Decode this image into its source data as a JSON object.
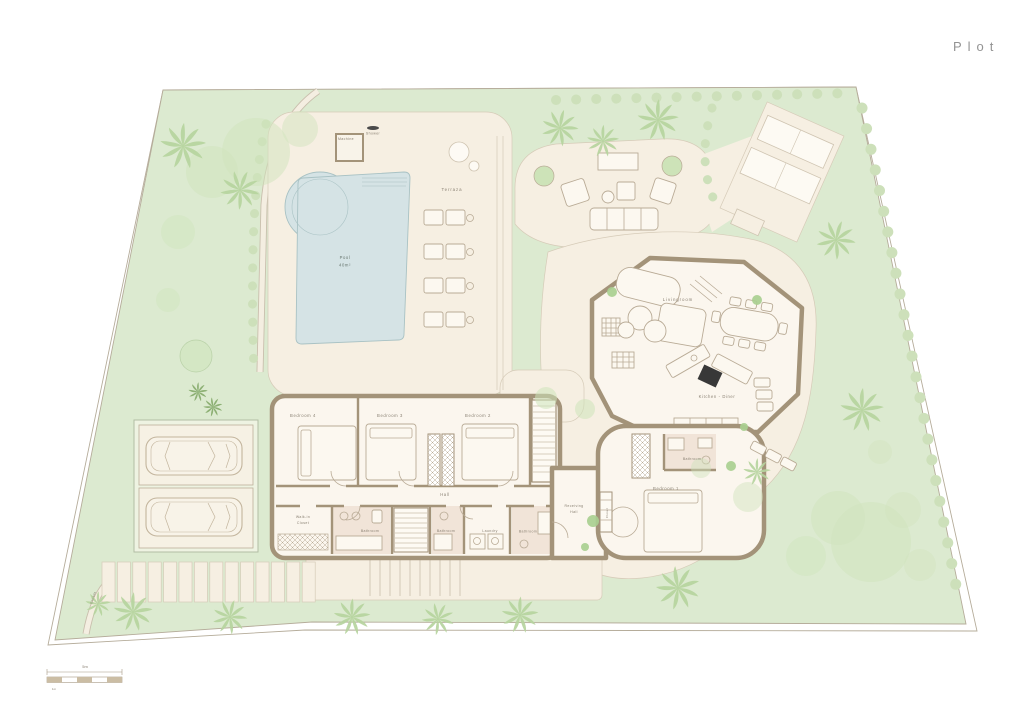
{
  "title": "Plot",
  "plan": {
    "outdoor": {
      "machine": "Machine",
      "shower": "Shower",
      "terrace": "Terraza",
      "pool_name": "Pool",
      "pool_area": "40m²",
      "entrance": "Entrada"
    },
    "house": {
      "livingroom": "Livingroom",
      "kitchen_diner": "Kitchen - Diner",
      "bedroom1": "Bedroom 1",
      "bedroom2": "Bedroom 2",
      "bedroom3": "Bedroom 3",
      "bedroom4": "Bedroom 4",
      "hall": "Hall",
      "walkin_line1": "Walk-in",
      "walkin_line2": "Closet",
      "bathroom_a": "Bathroom",
      "bathroom_b": "Bathroom",
      "bathroom_c": "Bathroom",
      "bathroom_ensuite": "Bathroom",
      "laundry": "Laundry",
      "receiving_line1": "Receiving",
      "receiving_line2": "Hall",
      "closet": "Closet"
    },
    "scale_bar": {
      "main": "5m",
      "sub": "1m"
    }
  },
  "colors": {
    "lawn": "#dcead0",
    "paving": "#f6efe2",
    "pool": "#d5e3e5",
    "wall": "#a39379",
    "bath_floor": "#eee0d4",
    "tree": "#b7d49f"
  }
}
